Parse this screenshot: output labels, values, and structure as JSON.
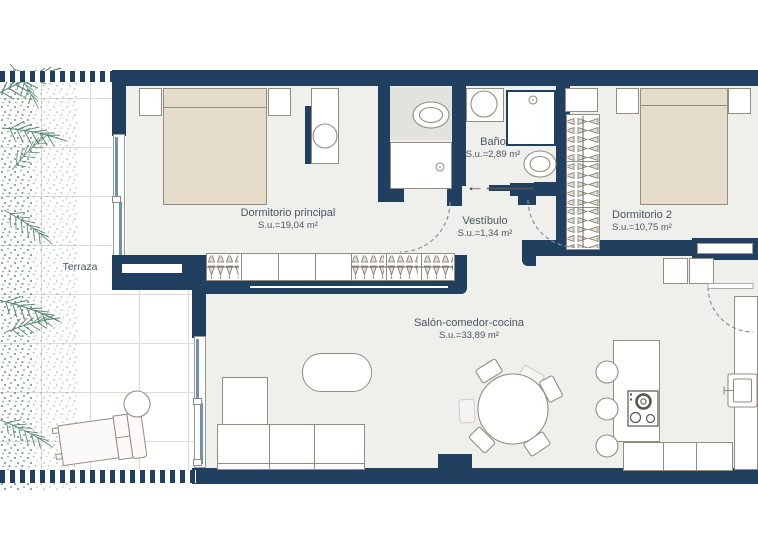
{
  "plan": {
    "rooms": {
      "terraza": {
        "name": "Terraza"
      },
      "dormitorio_principal": {
        "name": "Dormitorio principal",
        "area": "S.u.=19,04 m²"
      },
      "bano": {
        "name": "Baño",
        "area": "S.u.=2,89 m²"
      },
      "vestibulo": {
        "name": "Vestíbulo",
        "area": "S.u.=1,34 m²"
      },
      "dormitorio_2": {
        "name": "Dormitorio 2",
        "area": "S.u.=10,75 m²"
      },
      "salon_comedor_cocina": {
        "name": "Salón-comedor-cocina",
        "area": "S.u.=33,89 m²"
      }
    },
    "entrance_arrow": "←",
    "colors": {
      "wall": "#21405F",
      "floor": "#EFEFEC",
      "wet_floor": "#E2E2DF",
      "furniture_fill": "#E5DCCA",
      "furniture_outline": "#938D80",
      "line_gray": "#8C9097",
      "tile_line": "#DCDCD6",
      "vegetation": "#57866C",
      "window_glass": "#6E93AE",
      "label_text": "#4A5663"
    }
  }
}
